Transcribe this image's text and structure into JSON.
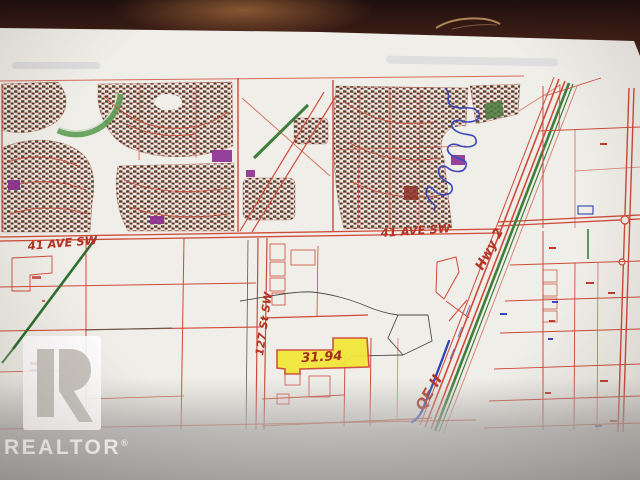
{
  "photo": {
    "watermark": {
      "logo_letter": "R",
      "brand": "REALTOR",
      "registered_symbol": "®"
    },
    "annotations": {
      "ave_sw_left": "41 AVE SW",
      "ave_sw_center": "41 AVE SW",
      "street_127": "127 St SW",
      "hwy_2": "Hwy 2",
      "qe_ii": "QE II",
      "parcel_acreage": "31.94"
    },
    "colors": {
      "wood_dark": "#1f0f0d",
      "wood_mid": "#3a1c16",
      "paper": "#f0eee8",
      "map_red": "#cf4a3a",
      "handwriting_red": "#b23325",
      "water_blue": "#3b49bb",
      "pen_blue": "#2e46b5",
      "green_road": "#3f7d3b",
      "highlight_yellow": "#f2e63a",
      "purple_zone": "#8c2f92",
      "shadow_gray": "#b2b0ae"
    }
  }
}
